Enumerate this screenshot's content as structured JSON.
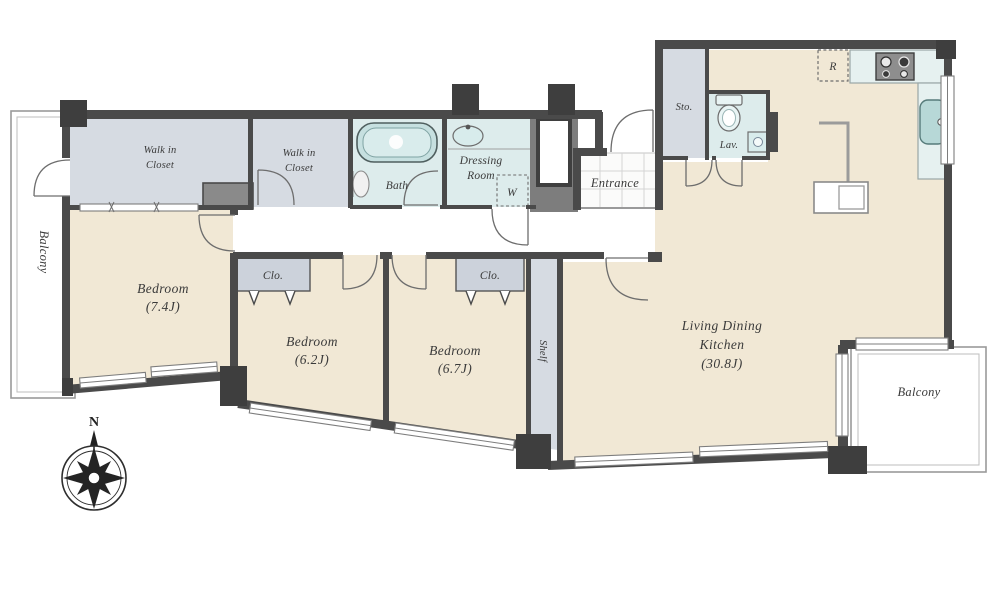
{
  "plan_type": "apartment-floor-plan",
  "compass": {
    "north_label": "N"
  },
  "rooms": {
    "balcony_left": {
      "label": "Balcony"
    },
    "walk_in_closet_1": {
      "line1": "Walk in",
      "line2": "Closet"
    },
    "walk_in_closet_2": {
      "line1": "Walk in",
      "line2": "Closet"
    },
    "bath": {
      "label": "Bath"
    },
    "dressing_room": {
      "line1": "Dressing",
      "line2": "Room"
    },
    "washer": {
      "label": "W"
    },
    "entrance": {
      "label": "Entrance"
    },
    "storage": {
      "label": "Sto."
    },
    "lavatory": {
      "label": "Lav."
    },
    "refrigerator": {
      "label": "R"
    },
    "bedroom_1": {
      "name": "Bedroom",
      "size": "(7.4J)"
    },
    "bedroom_2": {
      "name": "Bedroom",
      "size": "(6.2J)"
    },
    "bedroom_3": {
      "name": "Bedroom",
      "size": "(6.7J)"
    },
    "closet_1": {
      "label": "Clo."
    },
    "closet_2": {
      "label": "Clo."
    },
    "shelf": {
      "label": "Shelf"
    },
    "living_dining_kitchen": {
      "line1": "Living Dining",
      "line2": "Kitchen",
      "size": "(30.8J)"
    },
    "balcony_right": {
      "label": "Balcony"
    }
  },
  "colors": {
    "wall": "#4a4a4a",
    "dark_block": "#3e3e3e",
    "floor": "#f1e8d5",
    "closet": "#d6dbe2",
    "closet_box": "#ccd2db",
    "wet_area": "#ddecec",
    "counter": "#e6f1f0",
    "fixture": "#c0dcdb",
    "text": "#3a3a3a"
  }
}
